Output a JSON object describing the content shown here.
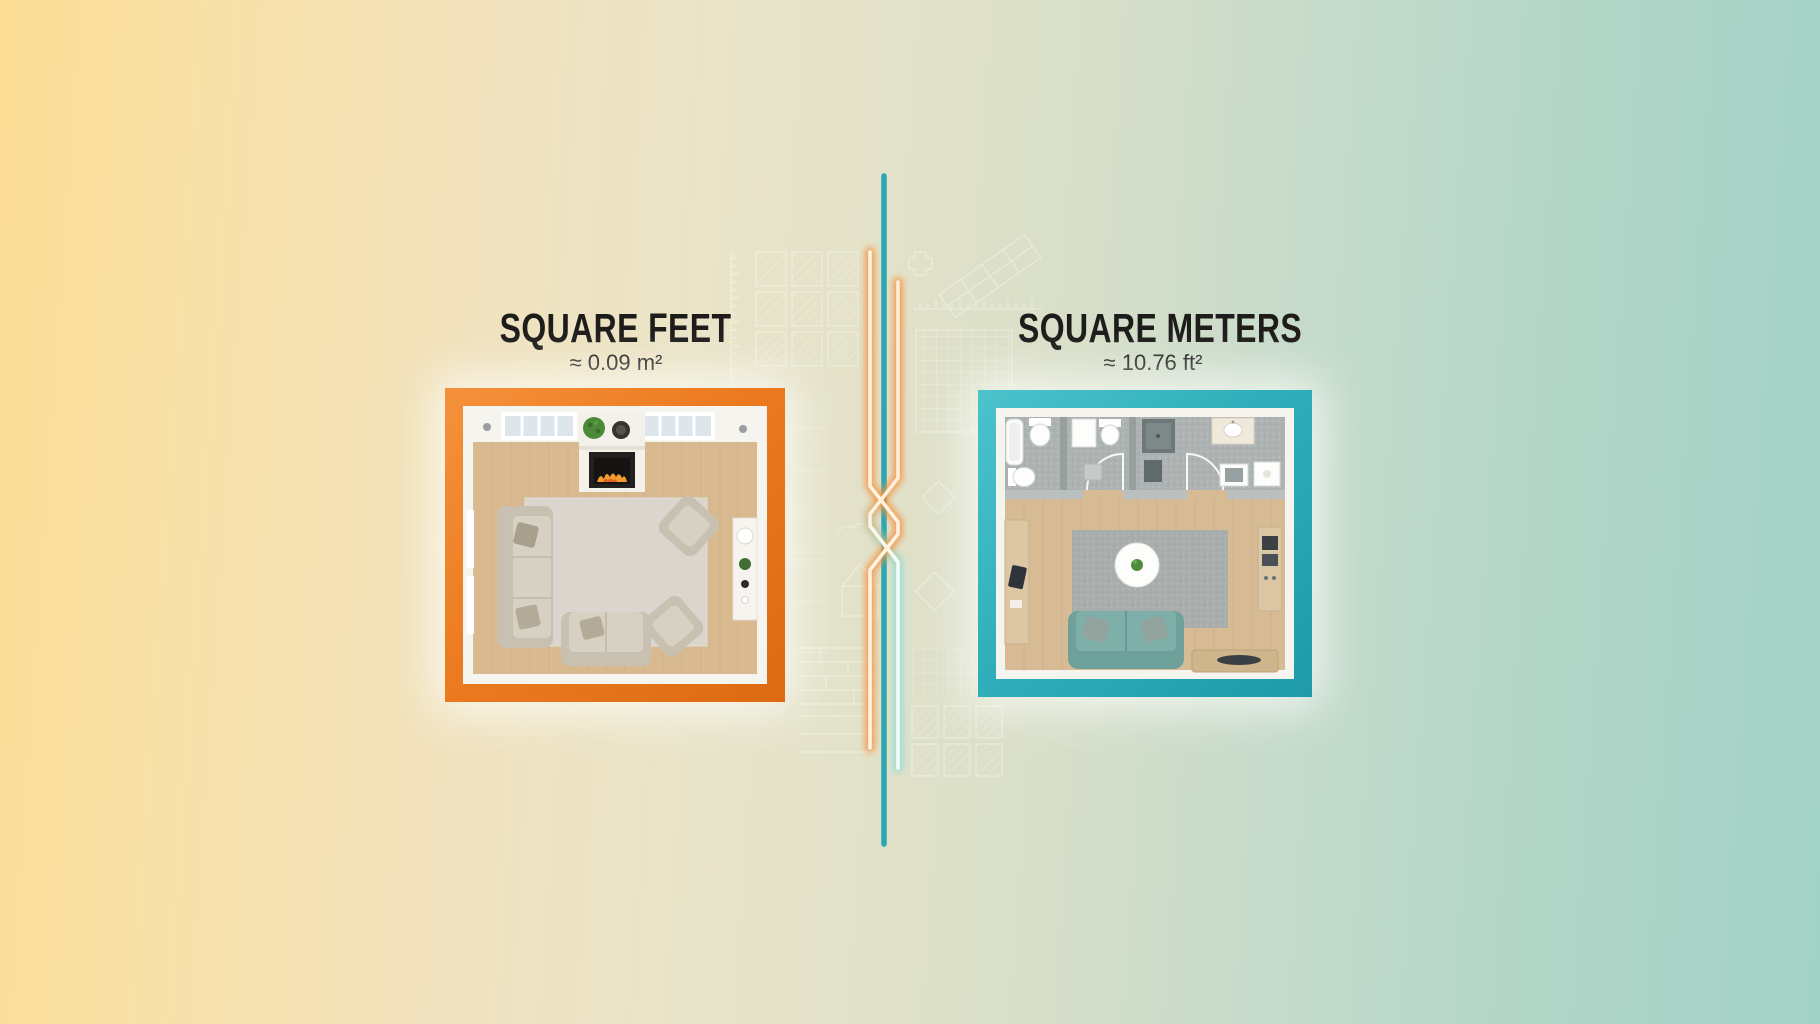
{
  "infographic": {
    "left": {
      "title": "SQUARE FEET",
      "subtitle": "≈ 0.09 m²",
      "accent_color": "#ec7b20",
      "illustration": "living-room-floorplan-top-view"
    },
    "right": {
      "title": "SQUARE METERS",
      "subtitle": "≈ 10.76 ft²",
      "accent_color": "#2fafba",
      "illustration": "apartment-floorplan-top-view"
    },
    "background": {
      "left_color": "#fbdc93",
      "right_color": "#a2d2c6"
    },
    "divider": {
      "style": "braided-neon-lines",
      "teal_line_color": "#2ba7b3",
      "neon_orange_color": "#f5923e",
      "neon_teal_color": "#8edcd6"
    }
  }
}
